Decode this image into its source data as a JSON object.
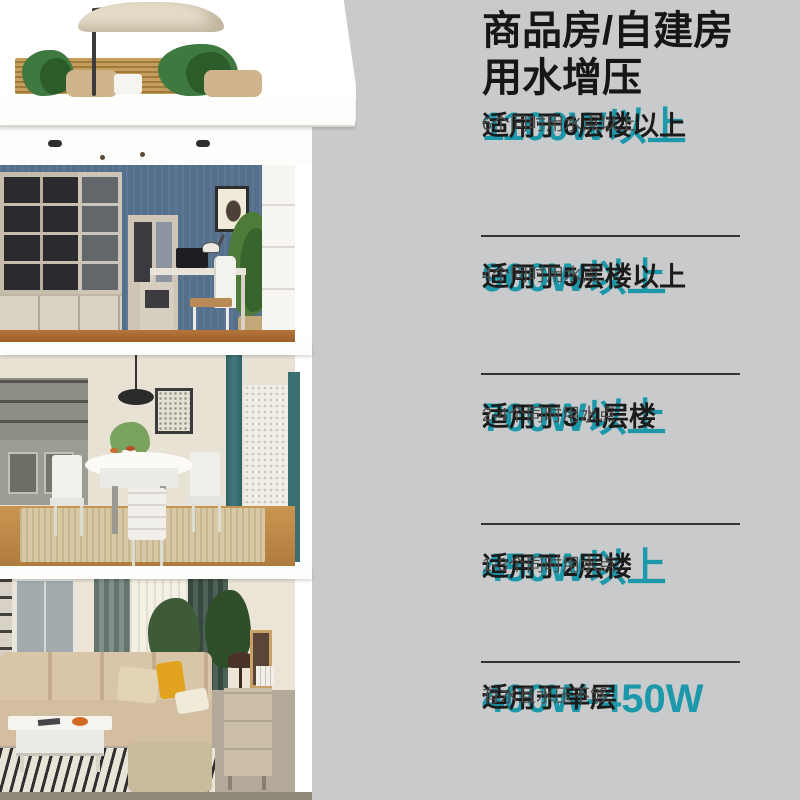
{
  "colors": {
    "background": "#c9cacb",
    "accent_teal": "#1b98aa",
    "heading_text": "#161616",
    "subtext_gray": "#4a4a4a",
    "divider": "#333333"
  },
  "panel": {
    "title_line1": "商品房/自建房",
    "title_line2": "用水增压",
    "blocks": [
      {
        "power": "1100W以上",
        "floors": "适用于6层楼以上",
        "points": "6个同时用水点以上"
      },
      {
        "power": "900W以上",
        "floors": "适用于5层楼以上",
        "points": "4个同时用水点"
      },
      {
        "power": "700W以上",
        "floors": "适用于3-4层楼",
        "points": "2-4个同时用水点"
      },
      {
        "power": "450W以上",
        "floors": "适用于2层楼",
        "points": "1-3个同时用水点"
      },
      {
        "power": "400W-450W",
        "floors": "适用于单层",
        "points": "有水且水压不够"
      }
    ]
  },
  "illustration": {
    "rooms": [
      "rooftop-terrace",
      "study",
      "dining-room",
      "living-room"
    ]
  }
}
